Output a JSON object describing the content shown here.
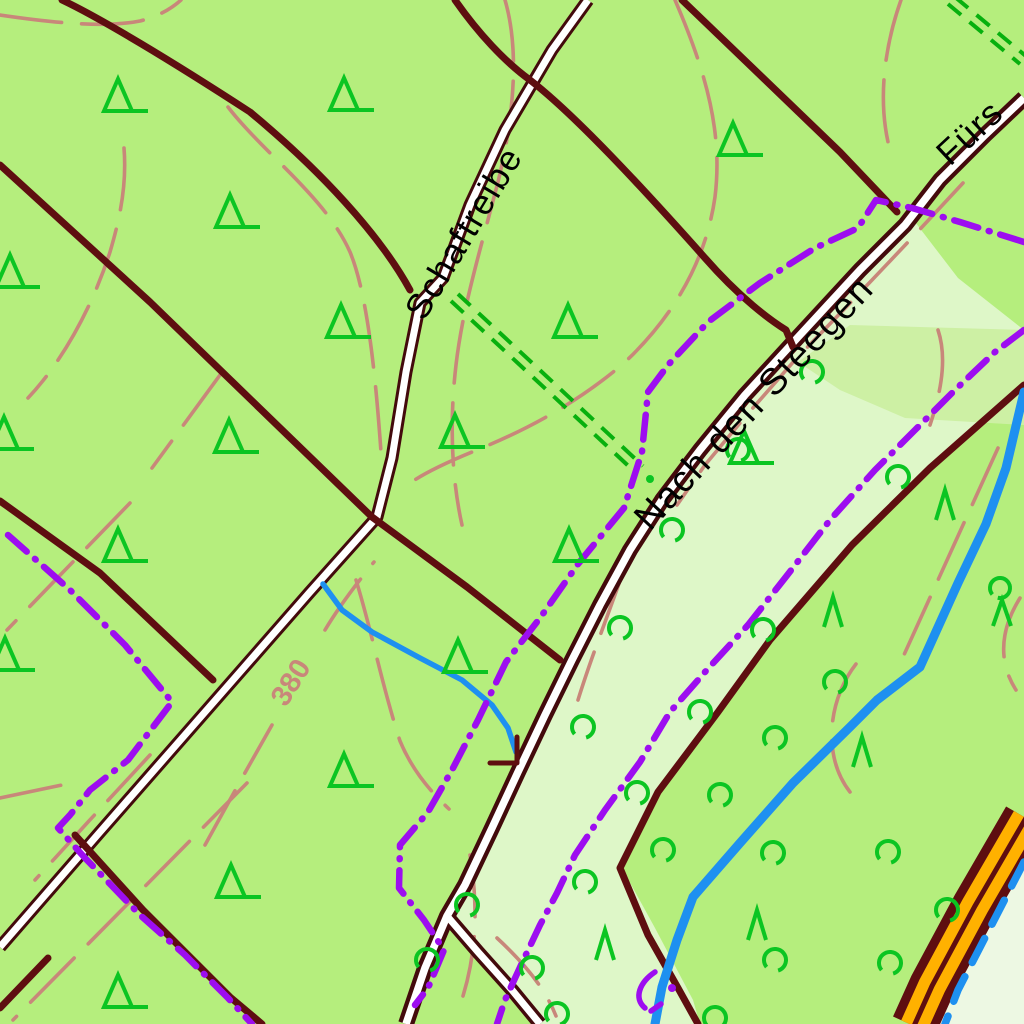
{
  "map": {
    "labels": {
      "road_schaftreibe": "Schaftreibe",
      "road_nach_den_steegen": "Nach den Steegen",
      "road_fuers": "Fürs",
      "contour_380": "380"
    },
    "colors": {
      "forest_green": "#b5ee7d",
      "meadow_green": "#def7c8",
      "patch_green": "#cdf0a4",
      "pale_corner": "#edf8e3",
      "track_maroon": "#5e0e10",
      "road_casing": "#430a0c",
      "road_fill": "#ffffff",
      "contour_salmon": "#c8877a",
      "boundary_purple": "#9d0df0",
      "symbol_green": "#0bc522",
      "ride_green": "#07b00e",
      "water_blue": "#1e90f0",
      "road_orange": "#ffb100",
      "label_black": "#000000"
    },
    "symbols": {
      "conifer_triangles": [
        [
          118,
          96
        ],
        [
          344,
          95
        ],
        [
          733,
          140
        ],
        [
          230,
          212
        ],
        [
          10,
          272
        ],
        [
          341,
          322
        ],
        [
          568,
          322
        ],
        [
          229,
          437
        ],
        [
          4,
          434
        ],
        [
          455,
          432
        ],
        [
          744,
          448
        ],
        [
          118,
          546
        ],
        [
          569,
          546
        ],
        [
          5,
          655
        ],
        [
          458,
          657
        ],
        [
          344,
          771
        ],
        [
          231,
          882
        ],
        [
          118,
          992
        ]
      ],
      "conifer_lambdas": [
        [
          945,
          505
        ],
        [
          833,
          612
        ],
        [
          862,
          752
        ],
        [
          605,
          945
        ],
        [
          757,
          925
        ]
      ],
      "deciduous_circles": [
        [
          812,
          372
        ],
        [
          738,
          450
        ],
        [
          898,
          477
        ],
        [
          672,
          530
        ],
        [
          620,
          628
        ],
        [
          763,
          630
        ],
        [
          583,
          727
        ],
        [
          700,
          712
        ],
        [
          775,
          738
        ],
        [
          720,
          795
        ],
        [
          637,
          793
        ],
        [
          663,
          850
        ],
        [
          585,
          882
        ],
        [
          467,
          905
        ],
        [
          532,
          968
        ],
        [
          427,
          960
        ],
        [
          557,
          1014
        ],
        [
          835,
          682
        ],
        [
          773,
          853
        ],
        [
          888,
          852
        ],
        [
          947,
          910
        ],
        [
          890,
          963
        ],
        [
          775,
          960
        ],
        [
          715,
          1018
        ]
      ],
      "mixed_trees": [
        [
          1000,
          600
        ]
      ]
    }
  }
}
